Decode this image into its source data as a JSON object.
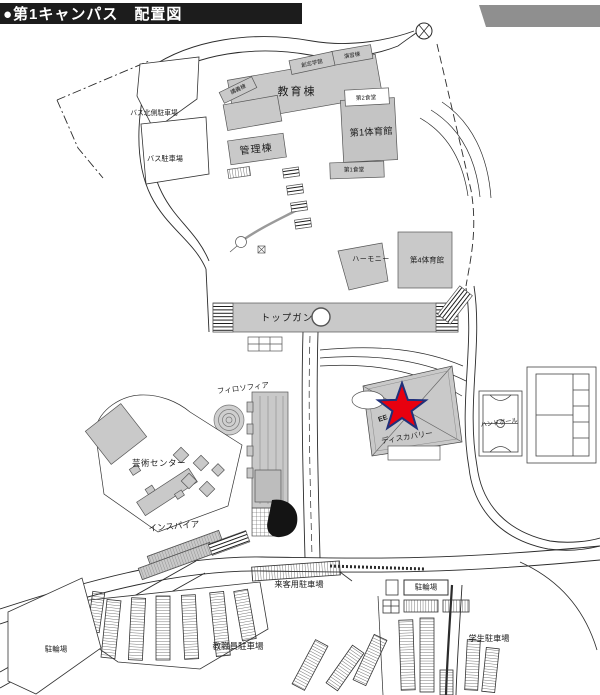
{
  "header": {
    "title": "●第1キャンパス　配置図"
  },
  "colors": {
    "header_bg": "#1c1c1c",
    "header_text": "#ffffff",
    "building_gray": "#c9c9c9",
    "band_gray": "#8f8f8f",
    "star_red": "#e8000f",
    "star_outline": "#20307a"
  },
  "map": {
    "buildings": {
      "education": "教育棟",
      "administration": "管理棟",
      "gym1": "第1体育館",
      "cafeteria2": "第2食堂",
      "cafeteria1": "第1食堂",
      "seminar": "演習棟",
      "gakkan": "創志学館",
      "lecture": "講義棟",
      "harmony": "ハーモニー",
      "gym4": "第4体育館",
      "topgun": "トップガン",
      "philosophia": "フィロソフィア",
      "art_center": "芸術センター",
      "inspire": "インスパイア",
      "discovery": "ディスカバリー",
      "discovery_roof": "EE",
      "handball": "ハンドボール"
    },
    "parking": {
      "bus_north": "バス北側駐車場",
      "bus": "バス駐車場",
      "visitor": "来客用駐車場",
      "bicycle_right": "駐輪場",
      "staff": "教職員駐車場",
      "student": "学生駐車場",
      "bicycle_left": "駐輪場"
    },
    "marker": {
      "type": "red-star",
      "points": 5
    }
  }
}
